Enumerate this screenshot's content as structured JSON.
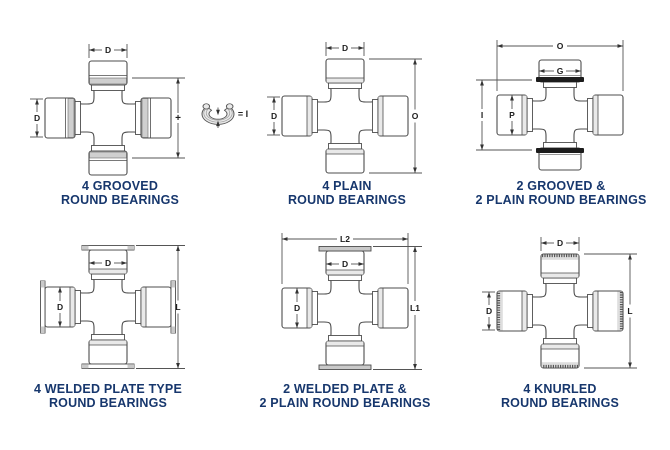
{
  "page": {
    "background": "#ffffff"
  },
  "colors": {
    "caption_text": "#17376d",
    "outline": "#4d4d4d",
    "dimension": "#555555",
    "arrow": "#333333",
    "label_text": "#1d1d1d",
    "light_shade": "#e9e9e9",
    "groove_shade": "#cfcfcf",
    "snap_ring_black": "#1c1c1c",
    "plate_shade": "#c9c9c9"
  },
  "diagrams": [
    {
      "name": "4-grooved-round-bearings",
      "caption": [
        "4 GROOVED",
        "ROUND BEARINGS"
      ],
      "dims": {
        "top": "D",
        "left": "D",
        "right": "+",
        "clip_equals": "= I"
      }
    },
    {
      "name": "4-plain-round-bearings",
      "caption": [
        "4 PLAIN",
        "ROUND BEARINGS"
      ],
      "dims": {
        "top": "D",
        "left": "D",
        "right": "O"
      }
    },
    {
      "name": "2-grooved-and-2-plain-round-bearings",
      "caption": [
        "2 GROOVED &",
        "2 PLAIN ROUND BEARINGS"
      ],
      "dims": {
        "overall_width": "O",
        "cap_width": "G",
        "left": "I",
        "cap_height": "P"
      }
    },
    {
      "name": "4-welded-plate-type-round-bearings",
      "caption": [
        "4 WELDED PLATE TYPE",
        "ROUND BEARINGS"
      ],
      "dims": {
        "cap_width": "D",
        "cap_height": "D",
        "right": "L"
      }
    },
    {
      "name": "2-welded-plate-and-2-plain-round-bearings",
      "caption": [
        "2 WELDED PLATE &",
        "2 PLAIN ROUND BEARINGS"
      ],
      "dims": {
        "overall_width": "L2",
        "cap_width": "D",
        "cap_height": "D",
        "right": "L1"
      }
    },
    {
      "name": "4-knurled-round-bearings",
      "caption": [
        "4 KNURLED",
        "ROUND BEARINGS"
      ],
      "dims": {
        "top": "D",
        "left": "D",
        "right": "L"
      }
    }
  ]
}
